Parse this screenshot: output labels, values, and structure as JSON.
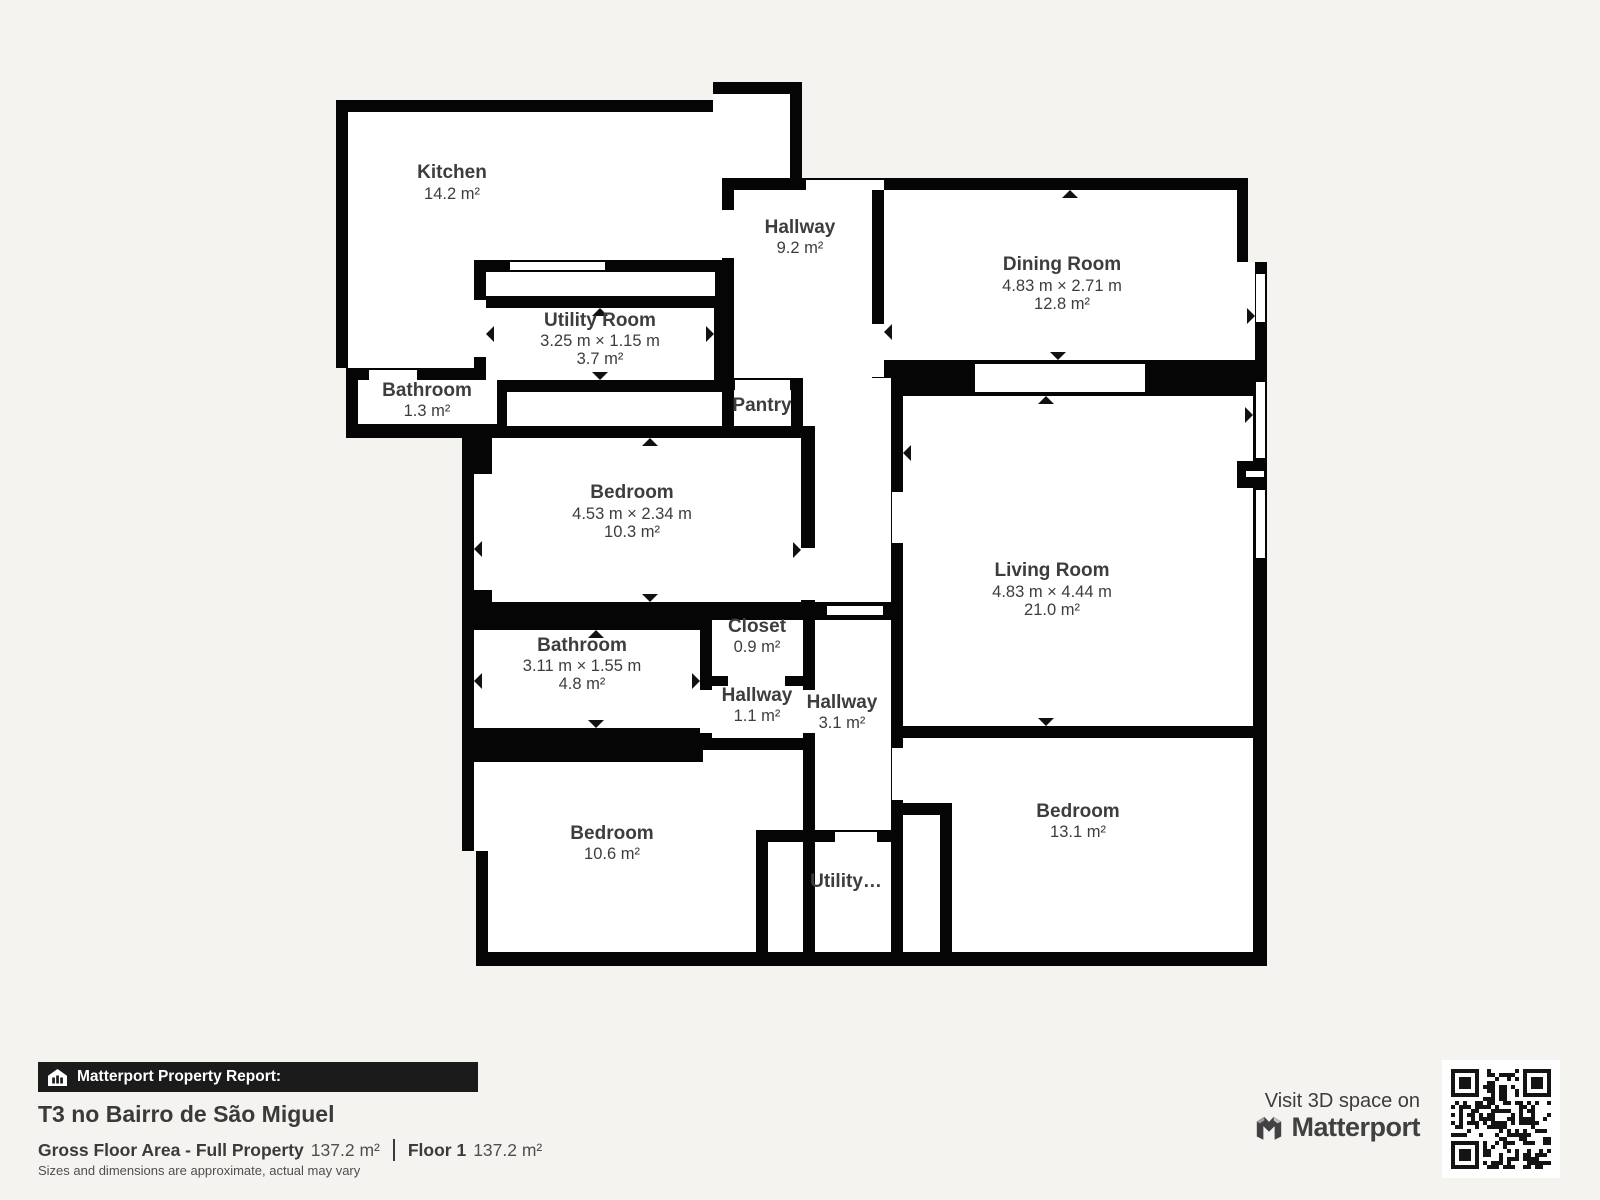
{
  "colors": {
    "wall": "#050505",
    "floor": "#ffffff",
    "background": "#f4f3f0",
    "label_text": "#3d3d3d"
  },
  "plan": {
    "rooms": [
      {
        "id": "kitchen",
        "name": "Kitchen",
        "area": "14.2 m²"
      },
      {
        "id": "hallway_top",
        "name": "Hallway",
        "area": "9.2 m²"
      },
      {
        "id": "dining_room",
        "name": "Dining Room",
        "dims": "4.83 m × 2.71 m",
        "area": "12.8 m²"
      },
      {
        "id": "utility_room",
        "name": "Utility Room",
        "dims": "3.25 m × 1.15 m",
        "area": "3.7 m²"
      },
      {
        "id": "bathroom_small",
        "name": "Bathroom",
        "area": "1.3 m²"
      },
      {
        "id": "pantry",
        "name": "Pantry"
      },
      {
        "id": "bedroom_middle",
        "name": "Bedroom",
        "dims": "4.53 m × 2.34 m",
        "area": "10.3 m²"
      },
      {
        "id": "living_room",
        "name": "Living Room",
        "dims": "4.83 m × 4.44 m",
        "area": "21.0 m²"
      },
      {
        "id": "closet",
        "name": "Closet",
        "area": "0.9 m²"
      },
      {
        "id": "bathroom_middle",
        "name": "Bathroom",
        "dims": "3.11 m × 1.55 m",
        "area": "4.8 m²"
      },
      {
        "id": "hallway_small",
        "name": "Hallway",
        "area": "1.1 m²"
      },
      {
        "id": "hallway_mid",
        "name": "Hallway",
        "area": "3.1 m²"
      },
      {
        "id": "bedroom_bottom_left",
        "name": "Bedroom",
        "area": "10.6 m²"
      },
      {
        "id": "utility_small",
        "name": "Utility…"
      },
      {
        "id": "bedroom_bottom_right",
        "name": "Bedroom",
        "area": "13.1 m²"
      }
    ]
  },
  "footer": {
    "report_label": "Matterport Property Report:",
    "property_title": "T3 no Bairro de São Miguel",
    "gfa_label": "Gross Floor Area - Full Property",
    "gfa_value": "137.2 m²",
    "floor_label": "Floor 1",
    "floor_value": "137.2 m²",
    "disclaimer": "Sizes and dimensions are approximate, actual may vary",
    "visit_text": "Visit 3D space on",
    "brand": "Matterport"
  }
}
